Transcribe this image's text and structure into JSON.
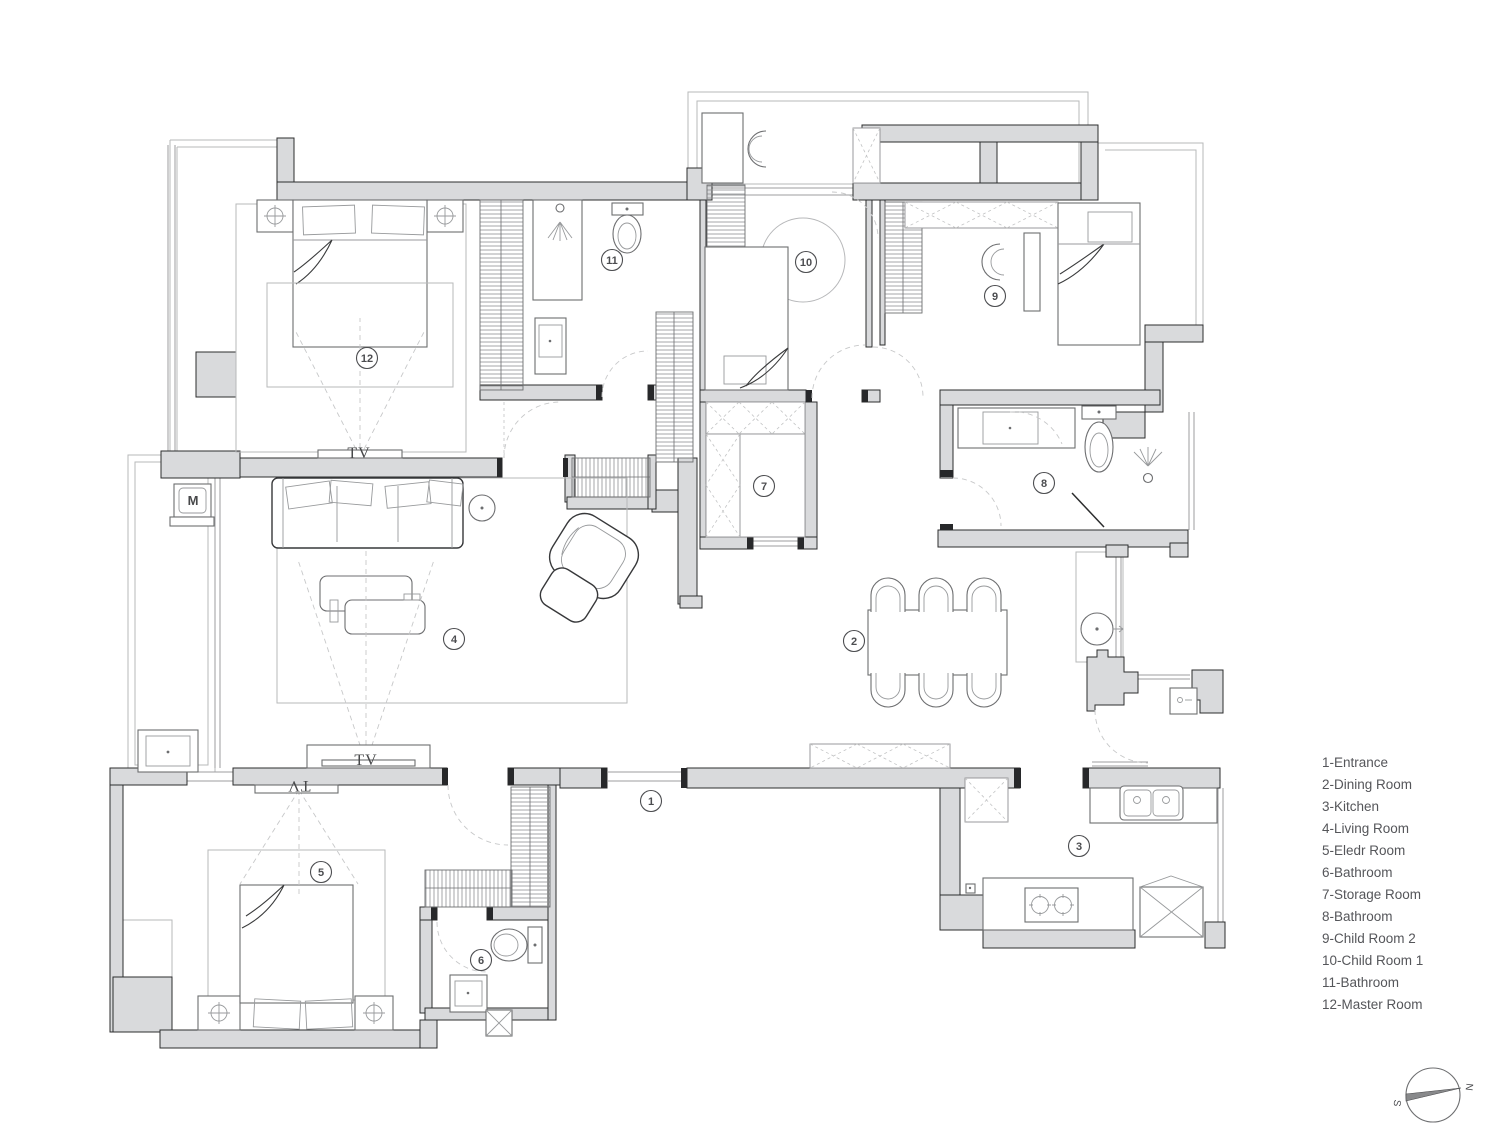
{
  "colors": {
    "wall_fill": "#d9dadc",
    "wall_line": "#2c2d2e",
    "light_line": "#b7b8ba",
    "text": "#55565a"
  },
  "legend": {
    "items": [
      "1-Entrance",
      "2-Dining Room",
      "3-Kitchen",
      "4-Living Room",
      "5-Eledr Room",
      "6-Bathroom",
      "7-Storage Room",
      "8-Bathroom",
      "9-Child Room 2",
      "10-Child Room 1",
      "11-Bathroom",
      "12-Master Room"
    ]
  },
  "rooms": [
    {
      "number": "1",
      "x": 651,
      "y": 801
    },
    {
      "number": "2",
      "x": 854,
      "y": 641
    },
    {
      "number": "3",
      "x": 1079,
      "y": 846
    },
    {
      "number": "4",
      "x": 454,
      "y": 639
    },
    {
      "number": "5",
      "x": 321,
      "y": 872
    },
    {
      "number": "6",
      "x": 481,
      "y": 960
    },
    {
      "number": "7",
      "x": 764,
      "y": 486
    },
    {
      "number": "8",
      "x": 1044,
      "y": 483
    },
    {
      "number": "9",
      "x": 995,
      "y": 296
    },
    {
      "number": "10",
      "x": 806,
      "y": 262
    },
    {
      "number": "11",
      "x": 612,
      "y": 260
    },
    {
      "number": "12",
      "x": 367,
      "y": 358
    }
  ],
  "labels": {
    "tv": "TV",
    "washer": "M"
  },
  "compass": {
    "north": "N",
    "south": "S"
  }
}
